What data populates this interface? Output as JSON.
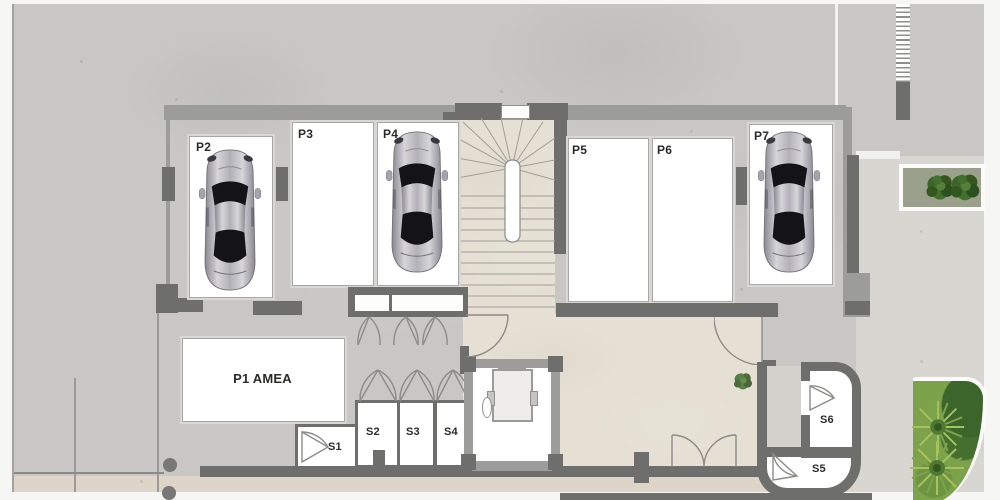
{
  "plan_title": "Parking level floor plan",
  "parking": {
    "p1": {
      "label": "P1 AMEA",
      "occupied": false
    },
    "p2": {
      "label": "P2",
      "occupied": true
    },
    "p3": {
      "label": "P3",
      "occupied": false
    },
    "p4": {
      "label": "P4",
      "occupied": true
    },
    "p5": {
      "label": "P5",
      "occupied": false
    },
    "p6": {
      "label": "P6",
      "occupied": false
    },
    "p7": {
      "label": "P7",
      "occupied": true
    }
  },
  "storage": {
    "s1": {
      "label": "S1"
    },
    "s2": {
      "label": "S2"
    },
    "s3": {
      "label": "S3"
    },
    "s4": {
      "label": "S4"
    },
    "s5": {
      "label": "S5"
    },
    "s6": {
      "label": "S6"
    }
  },
  "colors": {
    "concrete": "#c8c7c5",
    "corridor_floor": "#e5e0d3",
    "street": "#ddd6c8",
    "side_yard": "#d8d6d1",
    "wall_dark": "#6e6e6c",
    "wall_medium": "#9c9c9a",
    "stall_white": "#ffffff",
    "label_text": "#2b2b29",
    "shrub_green": "#3c652c",
    "grass_green": "#9cbf57",
    "car_silver": "#b6b4bb"
  }
}
